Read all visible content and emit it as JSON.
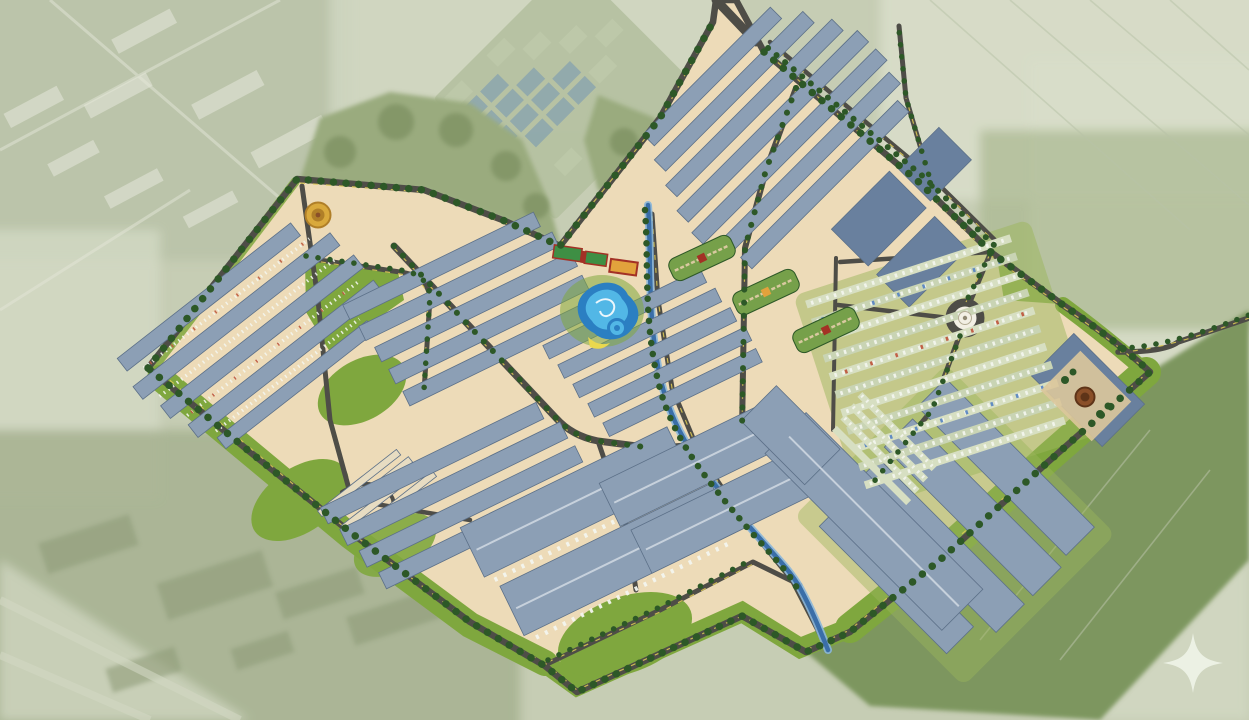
{
  "canvas": {
    "width": 1249,
    "height": 720
  },
  "scene": {
    "kind": "aerial-master-plan-rendering",
    "features": [
      "satellite-backdrop",
      "fish-pond-grid",
      "existing-vegetation",
      "site-platform",
      "perimeter-road-with-trees",
      "warehouse-row-clusters",
      "truck-parking-rows",
      "water-park-pool",
      "canal",
      "roundabout-monument",
      "golden-entry-plaza",
      "garden-axis-plazas",
      "amenity-train-buildings",
      "amphitheater-plaza",
      "sparkle-watermark"
    ]
  },
  "palette": {
    "background_base": "#c6cdb4",
    "bg_topleft": "#b8c2a8",
    "bg_pale": "#d2d8c3",
    "bg_right_pale": "#d8ddc9",
    "bg_olive": "#a7b292",
    "bg_dark_field": "#7d965e",
    "bg_ne_field": "#aab890",
    "bg_building_block": "#d9ddcc",
    "bg_field_line": "#b9c3a8",
    "bg_blob": "#8f9c79",
    "pond_water": "#8fa8ab",
    "pond_dike": "#b6c1a2",
    "pond_cell_pale": "#bcc8a8",
    "vegetation": "#9aab7e",
    "vegetation_dark": "#7b8f60",
    "site_ground": "#eddbb8",
    "site_edge": "#d9b571",
    "lawn": "#7fa73e",
    "lawn_light": "#9cb55c",
    "garden_green": "#76a04a",
    "garden_path": "#d9c9a0",
    "tree": "#2d5827",
    "road": "#4e4d47",
    "road_marking": "#d9c654",
    "roof": "#8c9fb5",
    "roof_dark": "#69809e",
    "roof_edge": "#5c7088",
    "roof_ridge": "#c7d1dc",
    "aisle": "#e7dcc2",
    "parking_row": "#d7dfc2",
    "parking_row_alt": "#c9d4b4",
    "truck_white": "#f4f6ef",
    "truck_blue": "#5b87c2",
    "truck_red": "#bf5a40",
    "water": "#3a6ea8",
    "water_light": "#8ab6d9",
    "pool_dark": "#2b7fc2",
    "pool_light": "#52b7e6",
    "pool_foam": "#eaf6fc",
    "pool_yellow": "#ead84e",
    "amenity_green": "#3e8f44",
    "amenity_red": "#a33125",
    "amenity_orange": "#e2a23c",
    "gold": "#d9a93c",
    "gold_dark": "#b07f28",
    "monument": "#f2efe4",
    "amphitheater": "#8a4f28",
    "plaza_tan": "#dcc79b",
    "sparkle": "#edf2e6"
  }
}
